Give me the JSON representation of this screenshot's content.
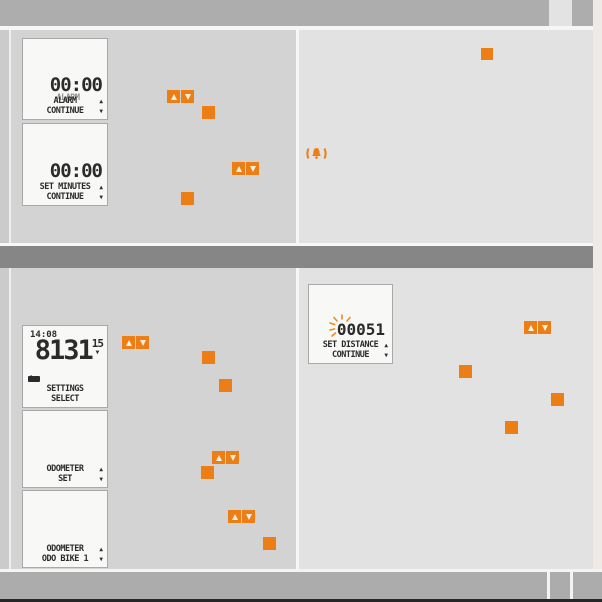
{
  "colors": {
    "accent_orange": "#EC7E15",
    "top_bar_gray": "#ADADAD",
    "divider_gray": "#868686",
    "left_panel_bg": "#D3D3D3",
    "right_panel_bg": "#E2E2E2",
    "lcd_bg": "#F8F8F6",
    "lcd_text": "#2B2B2B"
  },
  "top_panel": {
    "alarm_screen": {
      "time": "00:00",
      "line1": "ALARM",
      "line2": "CONTINUE",
      "up": "▲",
      "down": "▼"
    },
    "minutes_screen": {
      "time": "00:00",
      "line1": "SET MINUTES",
      "line2": "CONTINUE",
      "up": "▲",
      "down": "▼"
    }
  },
  "bottom_panel": {
    "settings_screen": {
      "clock": "14:08",
      "odometer": "8131",
      "trip": "15",
      "trip_down": "▼",
      "up_mark": "↑",
      "line1": "SETTINGS",
      "line2": "SELECT"
    },
    "odo_set_screen": {
      "line1": "ODOMETER",
      "line2": "SET",
      "up": "▲",
      "down": "▼"
    },
    "odo_bike_screen": {
      "line1": "ODOMETER",
      "line2": "ODO BIKE 1",
      "up": "▲",
      "down": "▼"
    },
    "distance_screen": {
      "blink_digit": "0",
      "digits": "0051",
      "line1": "SET DISTANCE",
      "line2": "CONTINUE",
      "up": "▲",
      "down": "▼"
    }
  },
  "icons": {
    "bell": "alarm-bell-icon",
    "up_button": "up-arrow-button",
    "down_button": "down-arrow-button",
    "square_marker": "button-press-marker"
  }
}
